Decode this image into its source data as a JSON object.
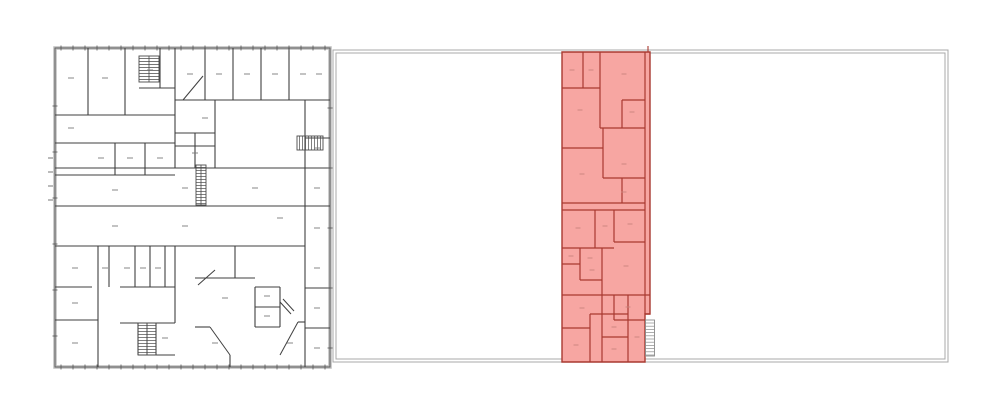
{
  "scene": {
    "width": 1000,
    "height": 416,
    "background": "#ffffff",
    "description": "Architectural drawing: detailed floor plan at left; site outline at right with red-highlighted wing"
  },
  "colors": {
    "plan_wall": "#3f3f3f",
    "plan_perimeter_band": "#bdbdbd",
    "plan_perimeter_edge": "#5a5a5a",
    "plan_tick": "#555555",
    "plan_label_dash": "#7a7a7a",
    "stair_hatch": "#4a4a4a",
    "outline_stroke": "#a8a8a8",
    "highlight_fill": "#f7a6a2",
    "highlight_wall": "#a93930",
    "highlight_label_dash": "#c9827c",
    "highlight_stair_hatch": "#8a8a8a",
    "highlight_stair_fill": "#ffffff"
  },
  "left_plan": {
    "origin": {
      "x": 55,
      "y": 48
    },
    "size": {
      "w": 275,
      "h": 319
    },
    "h_walls": [
      [
        0,
        120,
        67
      ],
      [
        84,
        120,
        40
      ],
      [
        0,
        120,
        95
      ],
      [
        0,
        120,
        127
      ],
      [
        120,
        275,
        52
      ],
      [
        120,
        160,
        85
      ],
      [
        120,
        160,
        98
      ],
      [
        250,
        275,
        90
      ],
      [
        0,
        275,
        120
      ],
      [
        0,
        250,
        158
      ],
      [
        0,
        250,
        198
      ],
      [
        250,
        275,
        158
      ],
      [
        250,
        275,
        240
      ],
      [
        250,
        275,
        280
      ],
      [
        0,
        37,
        239
      ],
      [
        0,
        43,
        272
      ],
      [
        65,
        120,
        239
      ],
      [
        65,
        120,
        275
      ],
      [
        83,
        120,
        307
      ],
      [
        140,
        200,
        230
      ],
      [
        200,
        225,
        239
      ],
      [
        200,
        225,
        259
      ],
      [
        200,
        225,
        279
      ],
      [
        140,
        155,
        279
      ],
      [
        243,
        250,
        274
      ]
    ],
    "v_walls": [
      [
        0,
        67,
        33
      ],
      [
        0,
        67,
        70
      ],
      [
        0,
        40,
        105
      ],
      [
        0,
        120,
        120
      ],
      [
        95,
        127,
        60
      ],
      [
        95,
        127,
        90
      ],
      [
        0,
        52,
        150
      ],
      [
        0,
        52,
        178
      ],
      [
        0,
        52,
        206
      ],
      [
        0,
        52,
        234
      ],
      [
        52,
        120,
        160
      ],
      [
        85,
        120,
        140
      ],
      [
        52,
        120,
        250
      ],
      [
        120,
        198,
        250
      ],
      [
        198,
        319,
        250
      ],
      [
        198,
        319,
        43
      ],
      [
        198,
        239,
        54
      ],
      [
        198,
        239,
        80
      ],
      [
        198,
        239,
        95
      ],
      [
        198,
        239,
        110
      ],
      [
        198,
        275,
        120
      ],
      [
        275,
        307,
        83
      ],
      [
        275,
        307,
        101
      ],
      [
        239,
        279,
        200
      ],
      [
        239,
        279,
        225
      ],
      [
        198,
        230,
        180
      ],
      [
        307,
        319,
        175
      ]
    ],
    "diagonals": [
      [
        128,
        52,
        148,
        28
      ],
      [
        143,
        237,
        160,
        222
      ],
      [
        155,
        279,
        175,
        307
      ],
      [
        225,
        307,
        243,
        274
      ],
      [
        225,
        254,
        236,
        266
      ],
      [
        228,
        251,
        239,
        263
      ]
    ],
    "stairs": [
      {
        "x": 84,
        "y": 8,
        "w": 20,
        "h": 26,
        "dir": "h",
        "rail": true
      },
      {
        "x": 242,
        "y": 88,
        "w": 26,
        "h": 14,
        "dir": "v",
        "rail": false
      },
      {
        "x": 141,
        "y": 117,
        "w": 10,
        "h": 40,
        "dir": "h",
        "rail": true
      },
      {
        "x": 83,
        "y": 275,
        "w": 9,
        "h": 32,
        "dir": "h",
        "rail": false
      },
      {
        "x": 92,
        "y": 275,
        "w": 9,
        "h": 32,
        "dir": "h",
        "rail": false
      }
    ],
    "edge_ticks": [
      {
        "orient": "h",
        "y": 0,
        "from": 6,
        "to": 270,
        "step": 12,
        "len": 5
      },
      {
        "orient": "h",
        "y": 319,
        "from": 6,
        "to": 270,
        "step": 12,
        "len": 5
      },
      {
        "orient": "v",
        "x": 0,
        "from": 58,
        "to": 300,
        "step": 46,
        "len": 5
      },
      {
        "orient": "v",
        "x": 275,
        "from": 60,
        "to": 300,
        "step": 60,
        "len": 5
      }
    ],
    "dim_dashes": [
      [
        -7,
        110
      ],
      [
        -7,
        124
      ],
      [
        -7,
        138
      ],
      [
        -7,
        152
      ]
    ],
    "label_dashes": [
      [
        16,
        30
      ],
      [
        50,
        30
      ],
      [
        95,
        22
      ],
      [
        135,
        26
      ],
      [
        164,
        26
      ],
      [
        192,
        26
      ],
      [
        220,
        26
      ],
      [
        248,
        26
      ],
      [
        264,
        26
      ],
      [
        16,
        80
      ],
      [
        46,
        110
      ],
      [
        75,
        110
      ],
      [
        105,
        110
      ],
      [
        60,
        142
      ],
      [
        130,
        140
      ],
      [
        200,
        140
      ],
      [
        60,
        178
      ],
      [
        130,
        178
      ],
      [
        225,
        170
      ],
      [
        150,
        70
      ],
      [
        140,
        105
      ],
      [
        262,
        100
      ],
      [
        262,
        140
      ],
      [
        262,
        180
      ],
      [
        262,
        220
      ],
      [
        262,
        260
      ],
      [
        262,
        300
      ],
      [
        20,
        220
      ],
      [
        50,
        220
      ],
      [
        72,
        220
      ],
      [
        88,
        220
      ],
      [
        103,
        220
      ],
      [
        20,
        255
      ],
      [
        20,
        295
      ],
      [
        110,
        290
      ],
      [
        170,
        250
      ],
      [
        212,
        248
      ],
      [
        212,
        268
      ],
      [
        160,
        295
      ],
      [
        235,
        295
      ]
    ]
  },
  "site_outline": {
    "outer": {
      "x": 333,
      "y": 50,
      "w": 615,
      "h": 312
    },
    "inner_offset": 3
  },
  "highlight_wing": {
    "origin": {
      "x": 562,
      "y": 52
    },
    "outline_polygon": [
      [
        0,
        0
      ],
      [
        88,
        0
      ],
      [
        88,
        262
      ],
      [
        83,
        262
      ],
      [
        83,
        310
      ],
      [
        0,
        310
      ]
    ],
    "h_walls": [
      [
        0,
        38,
        36
      ],
      [
        60,
        83,
        48
      ],
      [
        38,
        83,
        76
      ],
      [
        0,
        41,
        96
      ],
      [
        41,
        83,
        126
      ],
      [
        0,
        83,
        151
      ],
      [
        0,
        83,
        158
      ],
      [
        52,
        83,
        190
      ],
      [
        0,
        52,
        196
      ],
      [
        0,
        18,
        212
      ],
      [
        18,
        40,
        228
      ],
      [
        0,
        88,
        243
      ],
      [
        52,
        83,
        268
      ],
      [
        0,
        28,
        276
      ],
      [
        28,
        66,
        262
      ],
      [
        40,
        66,
        285
      ],
      [
        83,
        88,
        262
      ]
    ],
    "v_walls": [
      [
        0,
        36,
        21
      ],
      [
        0,
        76,
        38
      ],
      [
        48,
        76,
        60
      ],
      [
        76,
        126,
        41
      ],
      [
        126,
        151,
        60
      ],
      [
        158,
        196,
        33
      ],
      [
        158,
        190,
        52
      ],
      [
        196,
        228,
        18
      ],
      [
        196,
        310,
        40
      ],
      [
        243,
        268,
        52
      ],
      [
        262,
        310,
        28
      ],
      [
        243,
        310,
        66
      ],
      [
        0,
        262,
        83
      ]
    ],
    "stair": {
      "x": 83.5,
      "y": 268,
      "w": 9,
      "h": 36
    },
    "top_tick_x": 86,
    "label_dashes": [
      [
        10,
        18
      ],
      [
        29,
        18
      ],
      [
        62,
        22
      ],
      [
        18,
        58
      ],
      [
        70,
        60
      ],
      [
        20,
        122
      ],
      [
        62,
        112
      ],
      [
        62,
        140
      ],
      [
        16,
        176
      ],
      [
        43,
        174
      ],
      [
        68,
        172
      ],
      [
        9,
        204
      ],
      [
        28,
        206
      ],
      [
        30,
        218
      ],
      [
        64,
        214
      ],
      [
        66,
        255
      ],
      [
        20,
        256
      ],
      [
        14,
        293
      ],
      [
        52,
        275
      ],
      [
        52,
        297
      ],
      [
        75,
        285
      ]
    ]
  }
}
